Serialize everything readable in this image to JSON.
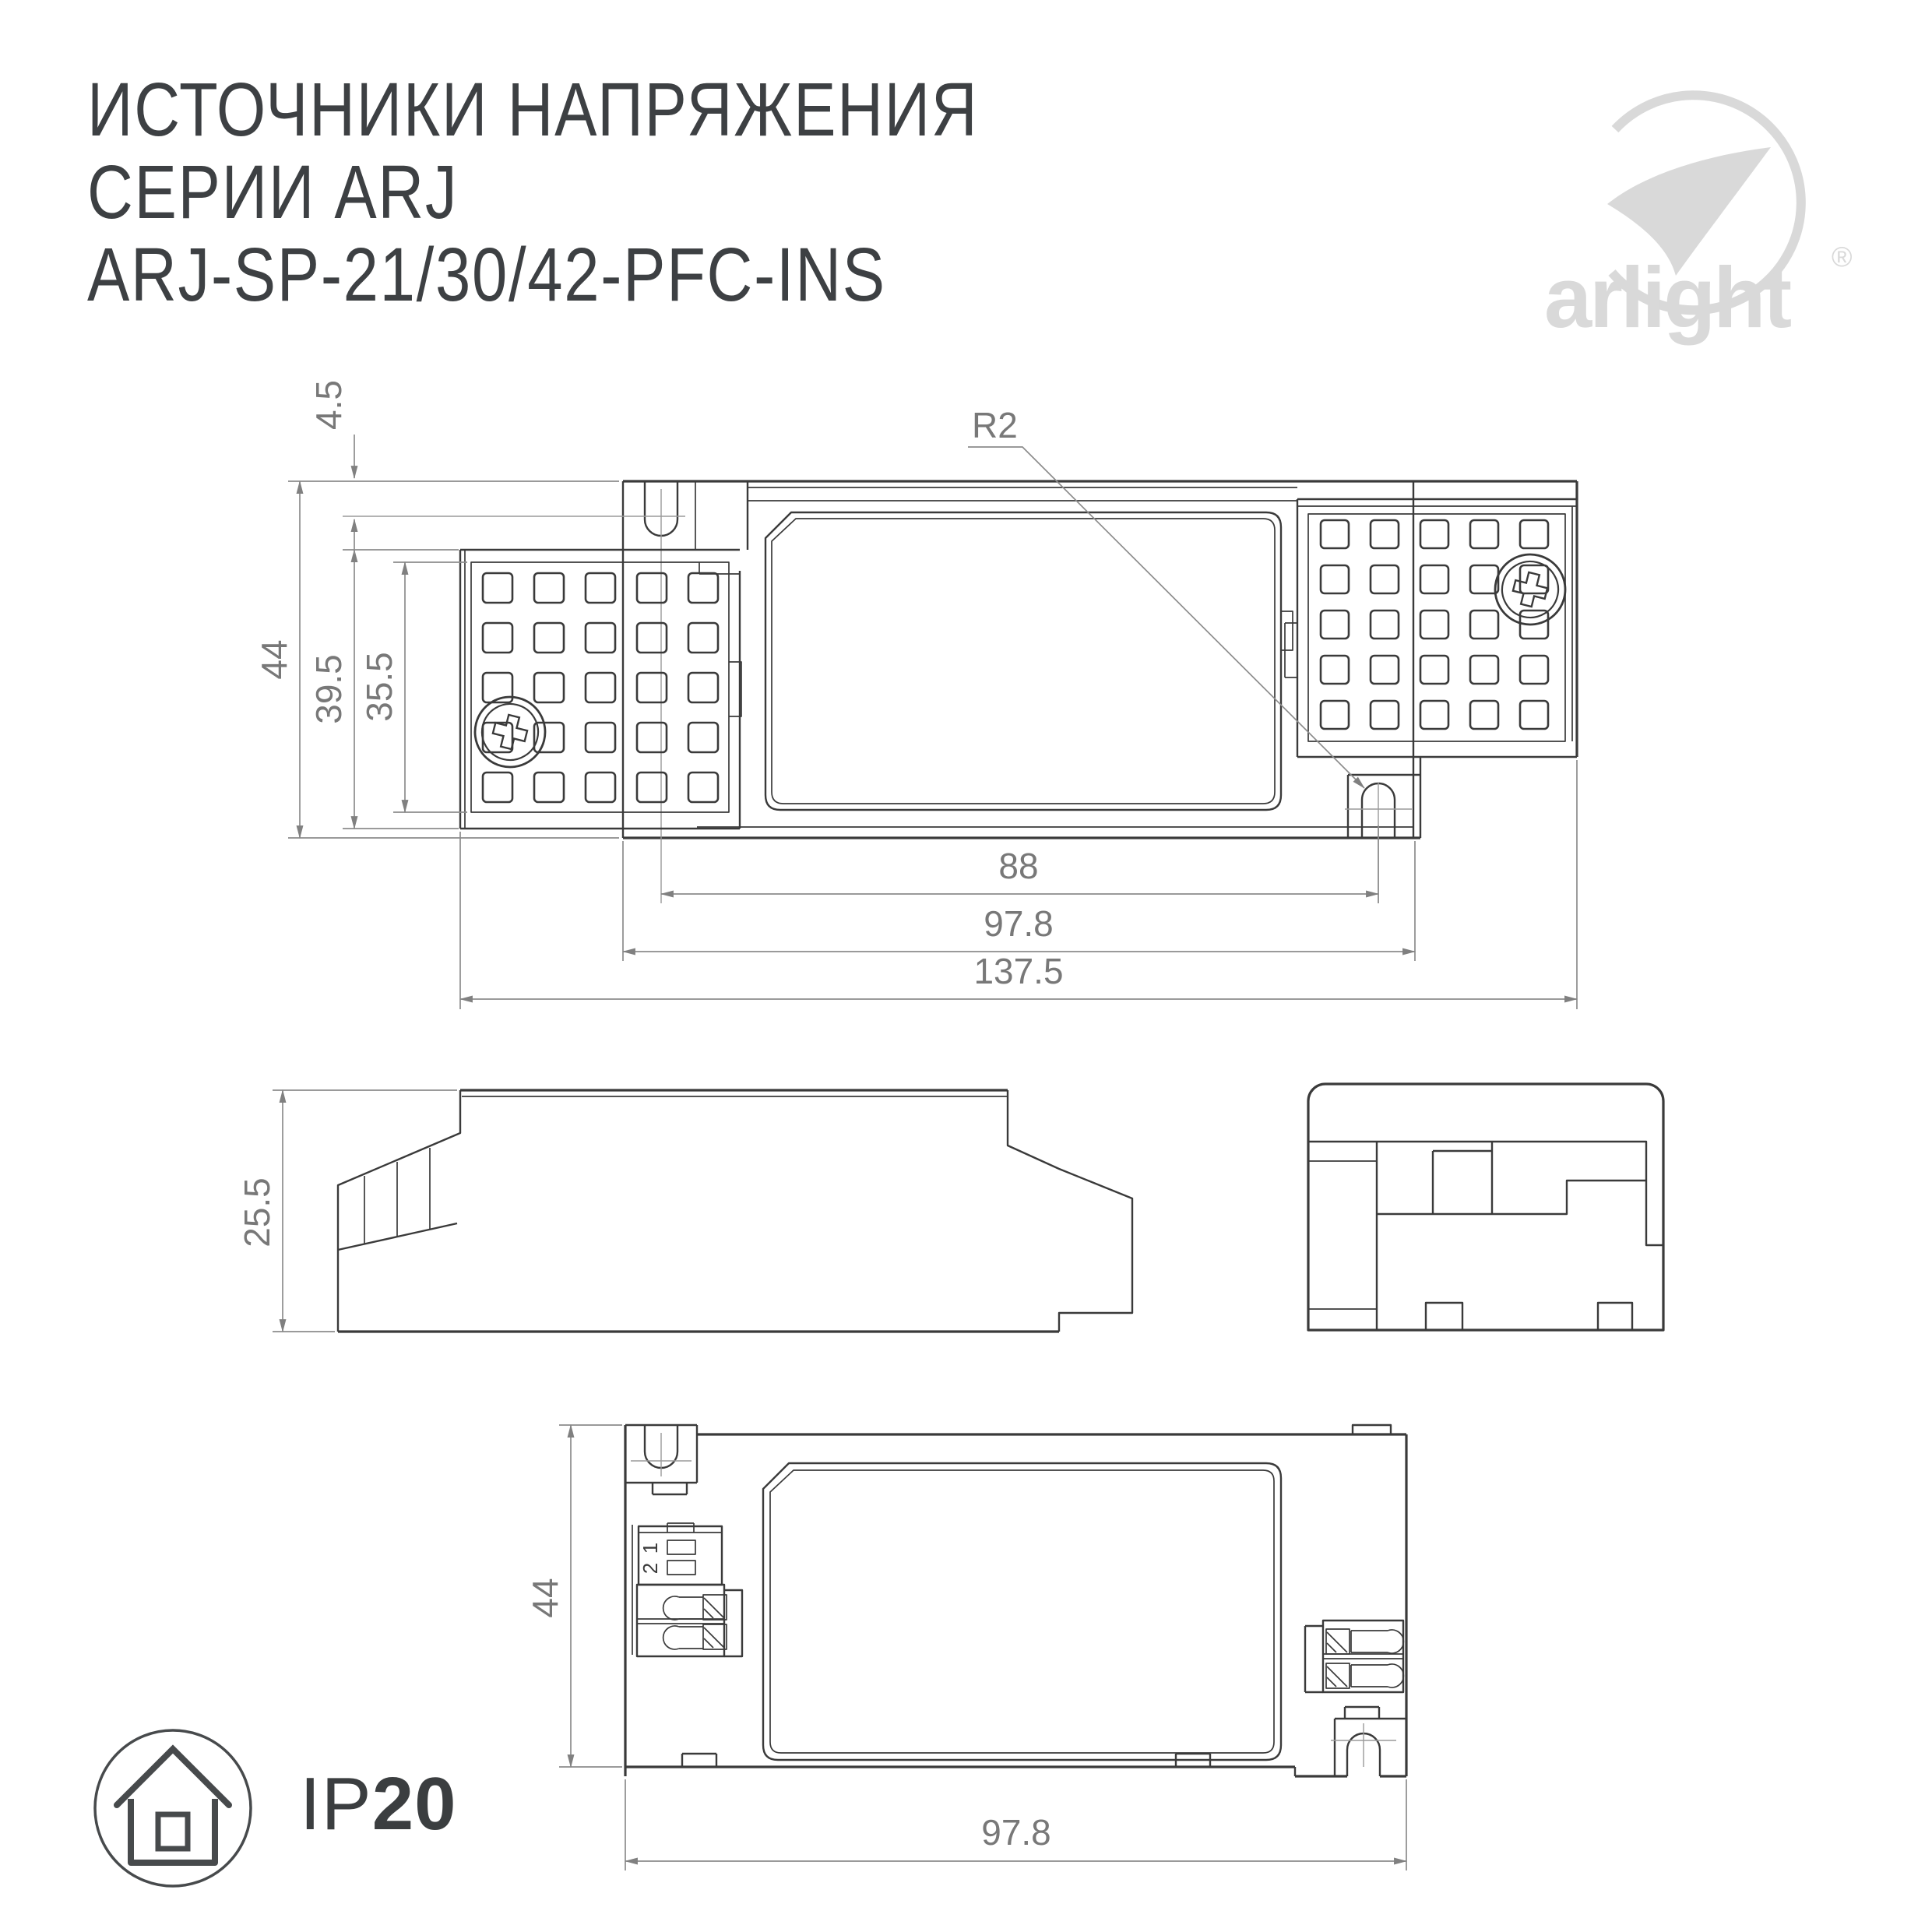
{
  "title": {
    "line1": "ИСТОЧНИКИ НАПРЯЖЕНИЯ",
    "line2": "СЕРИИ ARJ",
    "line3": "ARJ-SP-21/30/42-PFC-INS"
  },
  "logo": {
    "brand": "arlight",
    "registered": "®"
  },
  "ip_rating": {
    "prefix": "IP",
    "value": "20"
  },
  "views": {
    "top": {
      "dim_overall_height": "44",
      "dim_wing_height": "39.5",
      "dim_panel_height": "35.5",
      "dim_notch_offset": "4.5",
      "dim_radius": "R2",
      "dim_hole_spacing": "88",
      "dim_body_length": "97.8",
      "dim_overall_length": "137.5"
    },
    "side": {
      "dim_height": "25.5"
    },
    "bottom": {
      "dim_width": "44",
      "dim_length": "97.8",
      "terminal_1": "1",
      "terminal_2": "2"
    }
  },
  "colors": {
    "line": "#3a3a3a",
    "dim_line": "#8c8c8c",
    "dim_text": "#787878",
    "title_text": "#3d4043",
    "logo": "#d9d9d9"
  }
}
